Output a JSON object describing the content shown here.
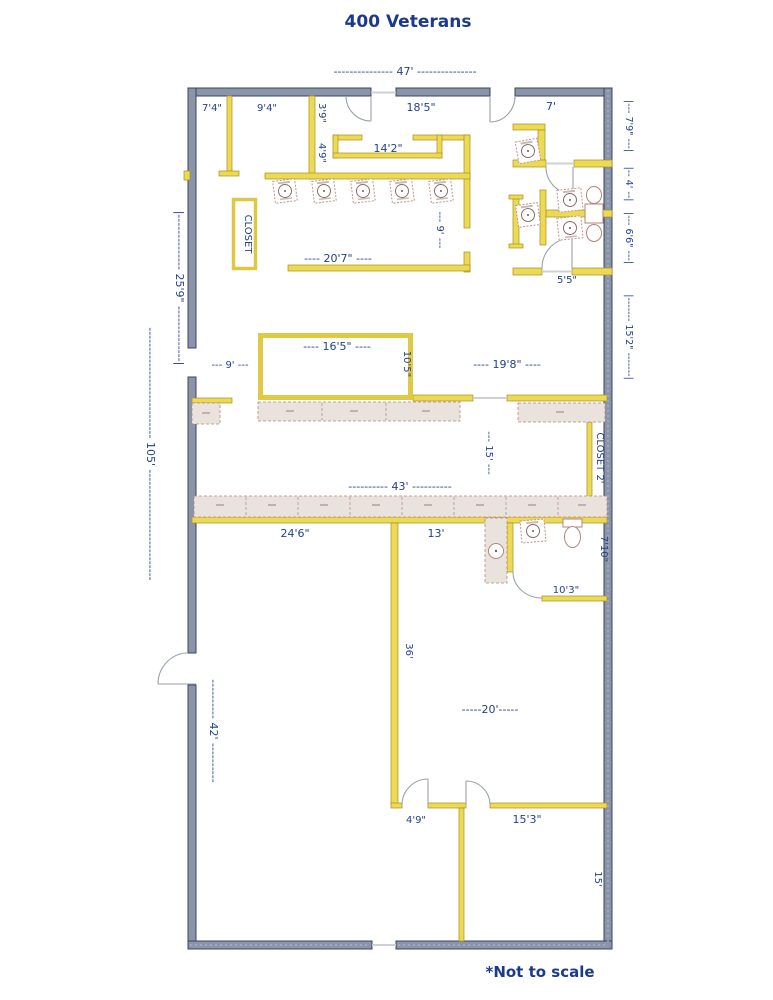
{
  "title": "400 Veterans",
  "footnote": "*Not to scale",
  "colors": {
    "label_text": "#23418c",
    "exterior_wall": "#8b95a9",
    "exterior_wall_outline": "#39455e",
    "interior_wall": "#edd954",
    "interior_wall_outline": "#a5901d",
    "counter_fill": "#eae3dd",
    "fixture_outline": "#b5857a",
    "door_arc": "#9aa2ad",
    "background": "#ffffff"
  },
  "labels": {
    "top_width": "--------------- 47' ---------------",
    "room_7_4": "7'4\"",
    "room_9_4": "9'4\"",
    "room_3_9": "3'9\"",
    "room_18_5": "18'5\"",
    "room_7": "7'",
    "room_4_9": "4'9\"",
    "room_14_2": "14'2\"",
    "dim_7_9": "|--- 7'9\" ---|",
    "dim_4": "|-- 4' --|",
    "dim_6_6": "|--- 6'6\" ---|",
    "dim_15_2": "|------- 15'2\" -------|",
    "dim_20_7": "---- 20'7\" ----",
    "dim_9_corridor": "--- 9' ---",
    "room_5_5": "5'5\"",
    "dim_25_9": "|-------------- 25'9\" --------------|",
    "dim_105": "---------------------------- 105' ----------------------------",
    "dim_9_left": "--- 9' ---",
    "dim_16_5": "---- 16'5\" ----",
    "room_10_5": "10'5\"",
    "dim_19_8": "---- 19'8\" ----",
    "dim_15_mid": "--- 15' ---",
    "dim_43": "---------- 43' ----------",
    "closet_1": "CLOSET",
    "closet_2": "CLOSET  2'",
    "room_24_6": "24'6\"",
    "room_13": "13'",
    "room_7_10": "7'10\"",
    "room_10_3": "10'3\"",
    "room_36": "36'",
    "dim_42": "---------- 42' ----------",
    "dim_20": "-----20'-----",
    "room_4_9b": "4'9\"",
    "room_15_3": "15'3\"",
    "room_15_br": "15'"
  }
}
